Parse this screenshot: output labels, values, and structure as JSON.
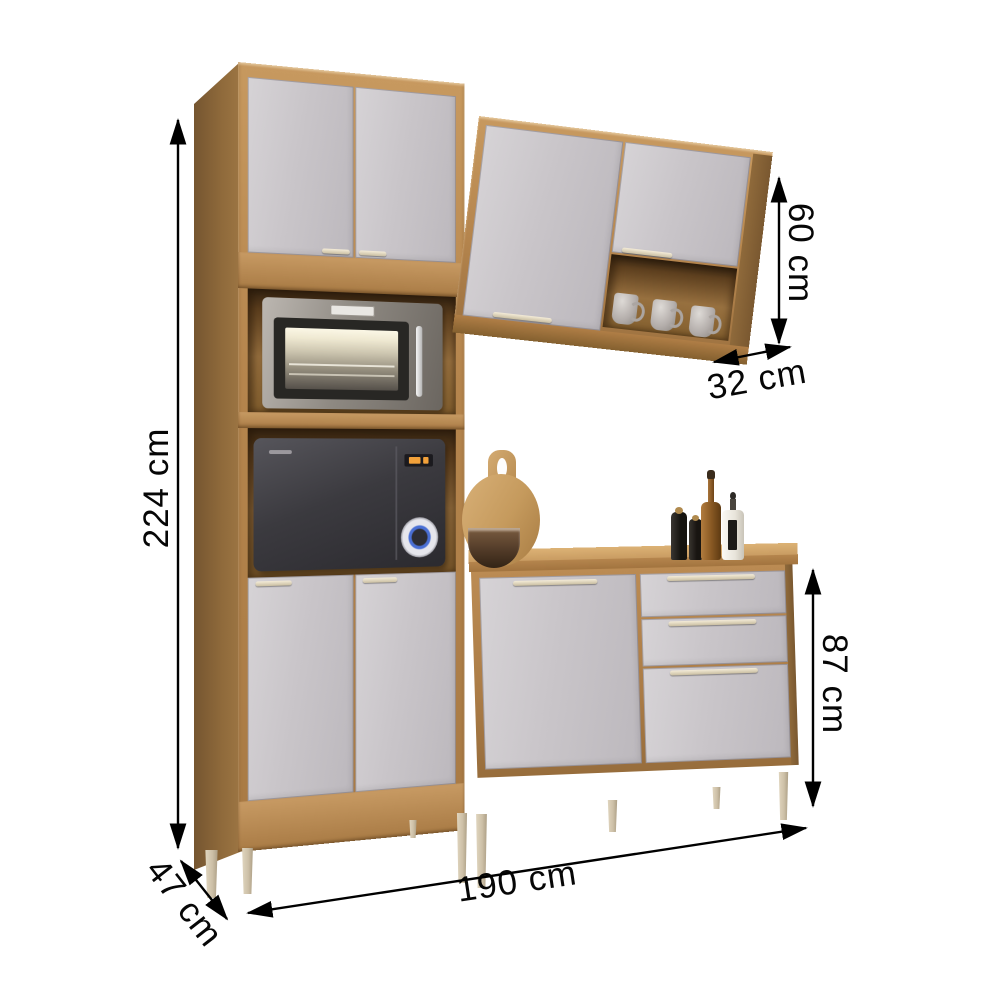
{
  "page": {
    "type": "product-dimension-diagram",
    "background": "#ffffff",
    "product": "kitchen cabinet set (tall pantry cabinet, wall cabinet, base cabinet)"
  },
  "dimensions": {
    "total_height": "224 cm",
    "wall_cabinet_height": "60 cm",
    "wall_cabinet_depth": "32 cm",
    "base_cabinet_height": "87 cm",
    "total_width": "190 cm",
    "total_depth": "47 cm"
  },
  "colors": {
    "wood_front": "#b5854d",
    "wood_side": "#826034",
    "wood_top": "#cfa76b",
    "door_gray": "#c7c3c6",
    "handle_champagne": "#e9dfc9",
    "leg_beige": "#d3c7b1",
    "niche_interior": "#6e4e27",
    "dimension_line": "#000000",
    "oven_steel": "#9a948c",
    "microwave_body": "#3b3a3f",
    "led_amber": "#f2a13a",
    "dial_blue": "#4a6fd4"
  },
  "objects": {
    "appliances": [
      "countertop-oven",
      "microwave"
    ],
    "mugs_count": 3,
    "decor": [
      "cutting-board",
      "bowl",
      "pepper-grinder",
      "pepper-grinder",
      "oil-bottle",
      "dropper-bottle"
    ]
  }
}
